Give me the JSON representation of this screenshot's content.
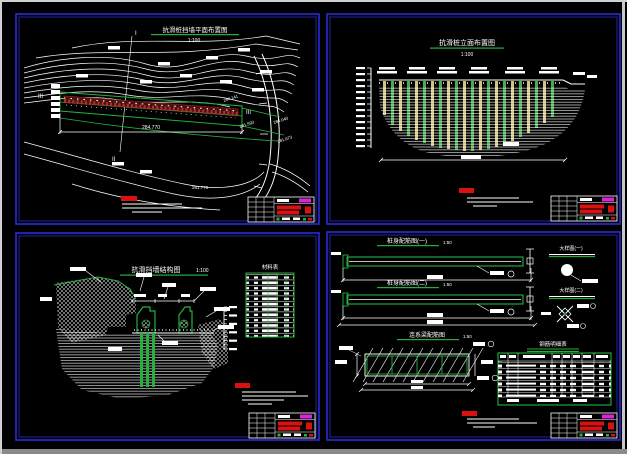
{
  "drawing": {
    "panel_plan": {
      "title": "抗滑桩挡墙平面布置图",
      "scale": "1:100",
      "dim_label": "284.770",
      "contour_label": "281.770",
      "side_labels": [
        "284.141",
        "281.593",
        "284.040",
        "281.673"
      ],
      "section_markers": [
        "I",
        "II",
        "III",
        "III"
      ]
    },
    "panel_elevation": {
      "title": "抗滑桩立面布置图",
      "scale": "1:100"
    },
    "panel_structure": {
      "title": "抗滑挡墙结构图",
      "scale": "1:100",
      "table_title": "材料表"
    },
    "panel_details": {
      "bar1_title": "桩身配筋图(一)",
      "bar2_title": "桩身配筋图(二)",
      "grid_title": "连系梁配筋图",
      "detail_scale": "1:50",
      "detail1_title": "大样图(一)",
      "detail2_title": "大样图(二)",
      "table_title": "钢筋明细表"
    },
    "colors": {
      "panel_border": "#2a2ad4",
      "line": "#ffffff",
      "structure_green": "#22b23c",
      "pile_yellow": "#d2c47c",
      "wall_red": "#8b1e1e",
      "stamp_red": "#d81111",
      "titleblock_magenta": "#dd22dd"
    }
  }
}
